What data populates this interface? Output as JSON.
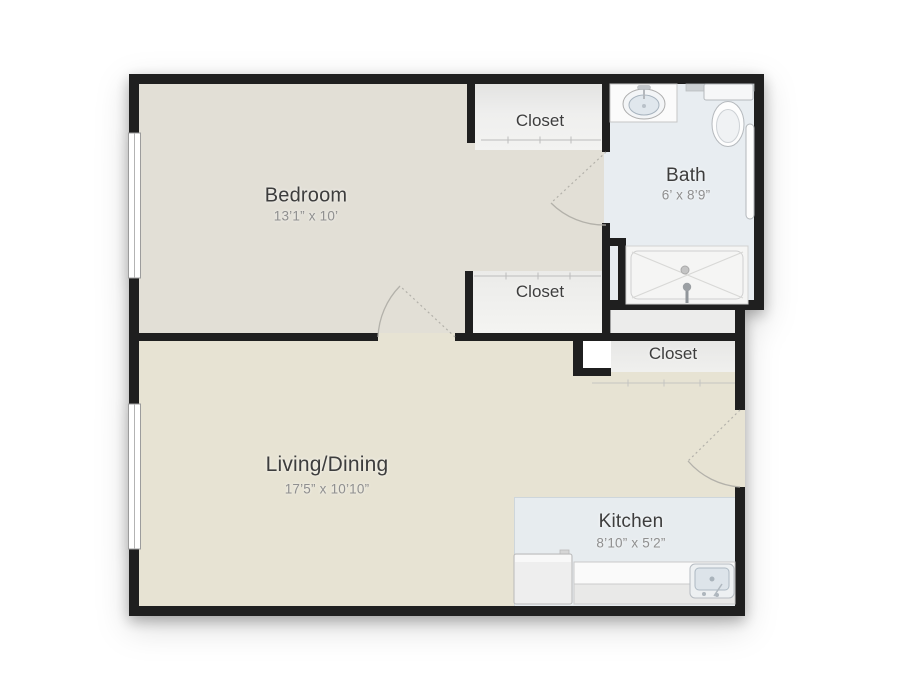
{
  "floorplan": {
    "rooms": {
      "bedroom": {
        "label": "Bedroom",
        "dimensions": "13’1” x 10’"
      },
      "closet_top": {
        "label": "Closet"
      },
      "bath": {
        "label": "Bath",
        "dimensions": "6’ x 8’9”"
      },
      "closet_middle": {
        "label": "Closet"
      },
      "closet_entry": {
        "label": "Closet"
      },
      "living_dining": {
        "label": "Living/Dining",
        "dimensions": "17’5” x 10’10”"
      },
      "kitchen": {
        "label": "Kitchen",
        "dimensions": "8’10” x 5’2”"
      }
    },
    "fixtures": [
      "vanity-sink",
      "toilet",
      "towel-bar",
      "shower",
      "refrigerator",
      "kitchen-counter",
      "kitchen-sink"
    ],
    "features": [
      "window-bedroom",
      "window-living",
      "door-bedroom",
      "door-bath",
      "door-entry",
      "closet-rod-top",
      "closet-rod-middle",
      "closet-front-entry"
    ],
    "colors": {
      "wall": "#1f1f1f",
      "bedroom_floor": "#e2dfd6",
      "living_floor": "#e7e3d3",
      "bath_floor": "#e8edf1",
      "kitchen_floor": "#e7ecef",
      "closet_floor": "#ebebea",
      "shower_pan": "#f5f5f4",
      "label_text": "#3d3d3d",
      "dimension_text": "#8f8f8f"
    }
  }
}
